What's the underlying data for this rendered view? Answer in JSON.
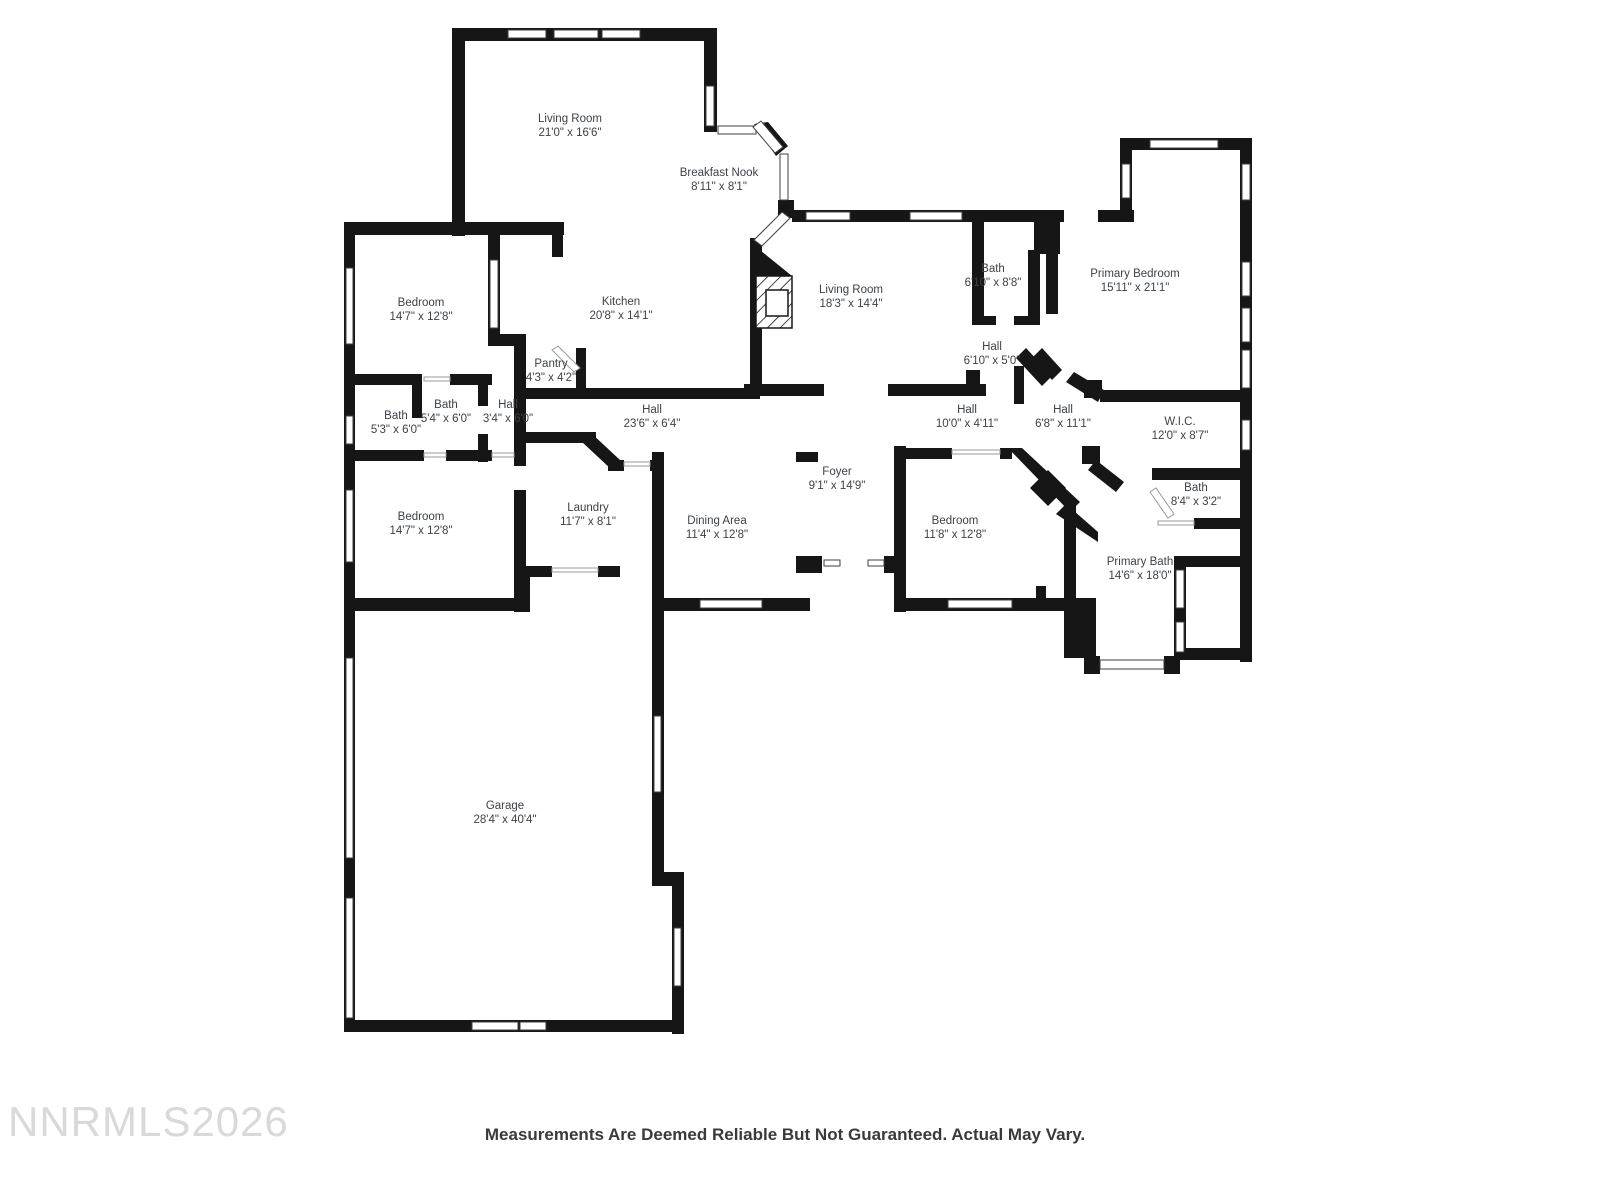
{
  "floorplan": {
    "rooms": [
      {
        "name": "Living Room",
        "dims": "21'0\" x 16'6\""
      },
      {
        "name": "Breakfast Nook",
        "dims": "8'11\" x 8'1\""
      },
      {
        "name": "Bedroom",
        "dims": "14'7\" x 12'8\""
      },
      {
        "name": "Kitchen",
        "dims": "20'8\" x 14'1\""
      },
      {
        "name": "Pantry",
        "dims": "4'3\" x 4'2\""
      },
      {
        "name": "Living Room",
        "dims": "18'3\" x 14'4\""
      },
      {
        "name": "Bath",
        "dims": "6'10\" x 8'8\""
      },
      {
        "name": "Hall",
        "dims": "6'10\" x 5'0\""
      },
      {
        "name": "Primary Bedroom",
        "dims": "15'11\" x 21'1\""
      },
      {
        "name": "Bath",
        "dims": "5'3\" x 6'0\""
      },
      {
        "name": "Bath",
        "dims": "5'4\" x 6'0\""
      },
      {
        "name": "Hall",
        "dims": "3'4\" x 6'0\""
      },
      {
        "name": "Hall",
        "dims": "23'6\" x 6'4\""
      },
      {
        "name": "Hall",
        "dims": "10'0\" x 4'11\""
      },
      {
        "name": "Hall",
        "dims": "6'8\" x 11'1\""
      },
      {
        "name": "W.I.C.",
        "dims": "12'0\" x 8'7\""
      },
      {
        "name": "Bath",
        "dims": "8'4\" x 3'2\""
      },
      {
        "name": "Foyer",
        "dims": "9'1\" x 14'9\""
      },
      {
        "name": "Bedroom",
        "dims": "14'7\" x 12'8\""
      },
      {
        "name": "Laundry",
        "dims": "11'7\" x 8'1\""
      },
      {
        "name": "Dining Area",
        "dims": "11'4\" x 12'8\""
      },
      {
        "name": "Bedroom",
        "dims": "11'8\" x 12'8\""
      },
      {
        "name": "Primary Bath",
        "dims": "14'6\" x 18'0\""
      },
      {
        "name": "Garage",
        "dims": "28'4\" x 40'4\""
      }
    ],
    "watermark": "NNRMLS2026",
    "disclaimer": "Measurements Are Deemed Reliable But Not Guaranteed. Actual May Vary.",
    "colors": {
      "wall": "#161616",
      "label_text": "#3d4247",
      "watermark_text": "#d9d9d9",
      "disclaimer_text": "#3a3a3a"
    }
  }
}
